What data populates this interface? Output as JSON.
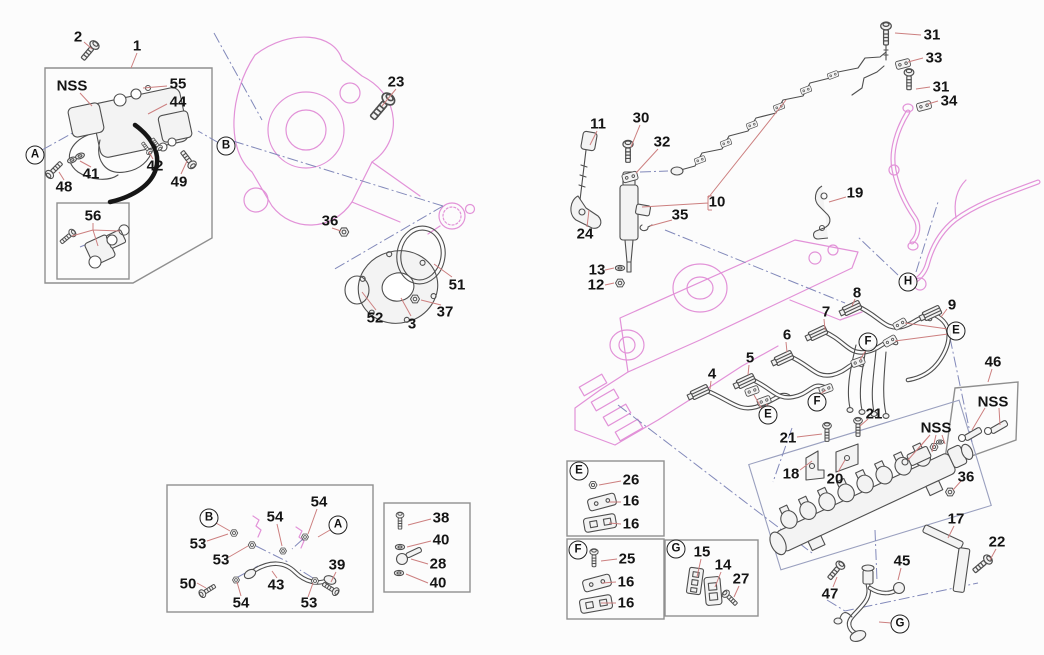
{
  "figure": {
    "type": "exploded-parts-diagram",
    "subject": "engine fuel injection system - injection pump, injectors, injection pipes and fuel rail"
  },
  "colors": {
    "background": "#fcfcfc",
    "label": "#141414",
    "callout_leader": "#cc7f7f",
    "construction_line": "#8289ba",
    "engine_outline": "#e292d8",
    "part_line": "#4f4f4f",
    "box_border": "#8f8f8f"
  },
  "callouts": [
    {
      "text": "2",
      "x": 78,
      "y": 37
    },
    {
      "text": "1",
      "x": 137,
      "y": 46
    },
    {
      "text": "55",
      "x": 178,
      "y": 84
    },
    {
      "text": "44",
      "x": 178,
      "y": 102
    },
    {
      "text": "23",
      "x": 396,
      "y": 82
    },
    {
      "text": "42",
      "x": 155,
      "y": 166
    },
    {
      "text": "49",
      "x": 179,
      "y": 182
    },
    {
      "text": "41",
      "x": 91,
      "y": 174
    },
    {
      "text": "48",
      "x": 64,
      "y": 187
    },
    {
      "text": "56",
      "x": 93,
      "y": 216
    },
    {
      "text": "36",
      "x": 330,
      "y": 221
    },
    {
      "text": "51",
      "x": 457,
      "y": 285
    },
    {
      "text": "52",
      "x": 375,
      "y": 318
    },
    {
      "text": "3",
      "x": 412,
      "y": 324
    },
    {
      "text": "37",
      "x": 445,
      "y": 312
    },
    {
      "text": "11",
      "x": 598,
      "y": 124
    },
    {
      "text": "30",
      "x": 641,
      "y": 118
    },
    {
      "text": "32",
      "x": 662,
      "y": 142
    },
    {
      "text": "10",
      "x": 717,
      "y": 202
    },
    {
      "text": "35",
      "x": 680,
      "y": 215
    },
    {
      "text": "24",
      "x": 585,
      "y": 234
    },
    {
      "text": "13",
      "x": 597,
      "y": 270
    },
    {
      "text": "12",
      "x": 596,
      "y": 285
    },
    {
      "text": "31",
      "x": 932,
      "y": 35
    },
    {
      "text": "33",
      "x": 934,
      "y": 58
    },
    {
      "text": "31",
      "x": 941,
      "y": 87
    },
    {
      "text": "34",
      "x": 949,
      "y": 101
    },
    {
      "text": "19",
      "x": 855,
      "y": 193
    },
    {
      "text": "8",
      "x": 857,
      "y": 293
    },
    {
      "text": "9",
      "x": 952,
      "y": 305
    },
    {
      "text": "7",
      "x": 826,
      "y": 312
    },
    {
      "text": "6",
      "x": 787,
      "y": 335
    },
    {
      "text": "5",
      "x": 750,
      "y": 358
    },
    {
      "text": "4",
      "x": 712,
      "y": 374
    },
    {
      "text": "21",
      "x": 874,
      "y": 414
    },
    {
      "text": "21",
      "x": 788,
      "y": 438
    },
    {
      "text": "18",
      "x": 791,
      "y": 474
    },
    {
      "text": "20",
      "x": 835,
      "y": 479
    },
    {
      "text": "46",
      "x": 993,
      "y": 362
    },
    {
      "text": "36",
      "x": 966,
      "y": 477
    },
    {
      "text": "17",
      "x": 956,
      "y": 519
    },
    {
      "text": "22",
      "x": 997,
      "y": 542
    },
    {
      "text": "45",
      "x": 902,
      "y": 561
    },
    {
      "text": "47",
      "x": 830,
      "y": 594
    },
    {
      "text": "54",
      "x": 319,
      "y": 502
    },
    {
      "text": "54",
      "x": 275,
      "y": 517
    },
    {
      "text": "53",
      "x": 198,
      "y": 544
    },
    {
      "text": "53",
      "x": 221,
      "y": 560
    },
    {
      "text": "39",
      "x": 337,
      "y": 565
    },
    {
      "text": "50",
      "x": 188,
      "y": 584
    },
    {
      "text": "43",
      "x": 276,
      "y": 585
    },
    {
      "text": "54",
      "x": 241,
      "y": 603
    },
    {
      "text": "53",
      "x": 309,
      "y": 603
    },
    {
      "text": "38",
      "x": 441,
      "y": 518
    },
    {
      "text": "40",
      "x": 441,
      "y": 540
    },
    {
      "text": "28",
      "x": 438,
      "y": 564
    },
    {
      "text": "40",
      "x": 438,
      "y": 583
    },
    {
      "text": "26",
      "x": 631,
      "y": 480
    },
    {
      "text": "16",
      "x": 631,
      "y": 501
    },
    {
      "text": "16",
      "x": 631,
      "y": 524
    },
    {
      "text": "25",
      "x": 627,
      "y": 559
    },
    {
      "text": "16",
      "x": 626,
      "y": 582
    },
    {
      "text": "16",
      "x": 626,
      "y": 603
    },
    {
      "text": "15",
      "x": 702,
      "y": 552
    },
    {
      "text": "14",
      "x": 723,
      "y": 565
    },
    {
      "text": "27",
      "x": 741,
      "y": 579
    }
  ],
  "nss_labels": [
    {
      "text": "NSS",
      "x": 72,
      "y": 86
    },
    {
      "text": "NSS",
      "x": 936,
      "y": 428
    },
    {
      "text": "NSS",
      "x": 993,
      "y": 402
    }
  ],
  "letter_markers": [
    {
      "text": "A",
      "x": 35,
      "y": 155
    },
    {
      "text": "B",
      "x": 226,
      "y": 146
    },
    {
      "text": "H",
      "x": 908,
      "y": 282
    },
    {
      "text": "E",
      "x": 956,
      "y": 331
    },
    {
      "text": "F",
      "x": 868,
      "y": 342
    },
    {
      "text": "F",
      "x": 817,
      "y": 402
    },
    {
      "text": "E",
      "x": 768,
      "y": 415
    },
    {
      "text": "G",
      "x": 900,
      "y": 624
    },
    {
      "text": "B",
      "x": 209,
      "y": 518
    },
    {
      "text": "A",
      "x": 338,
      "y": 525
    },
    {
      "text": "E",
      "x": 579,
      "y": 471
    },
    {
      "text": "F",
      "x": 578,
      "y": 550
    },
    {
      "text": "G",
      "x": 676,
      "y": 549
    }
  ]
}
